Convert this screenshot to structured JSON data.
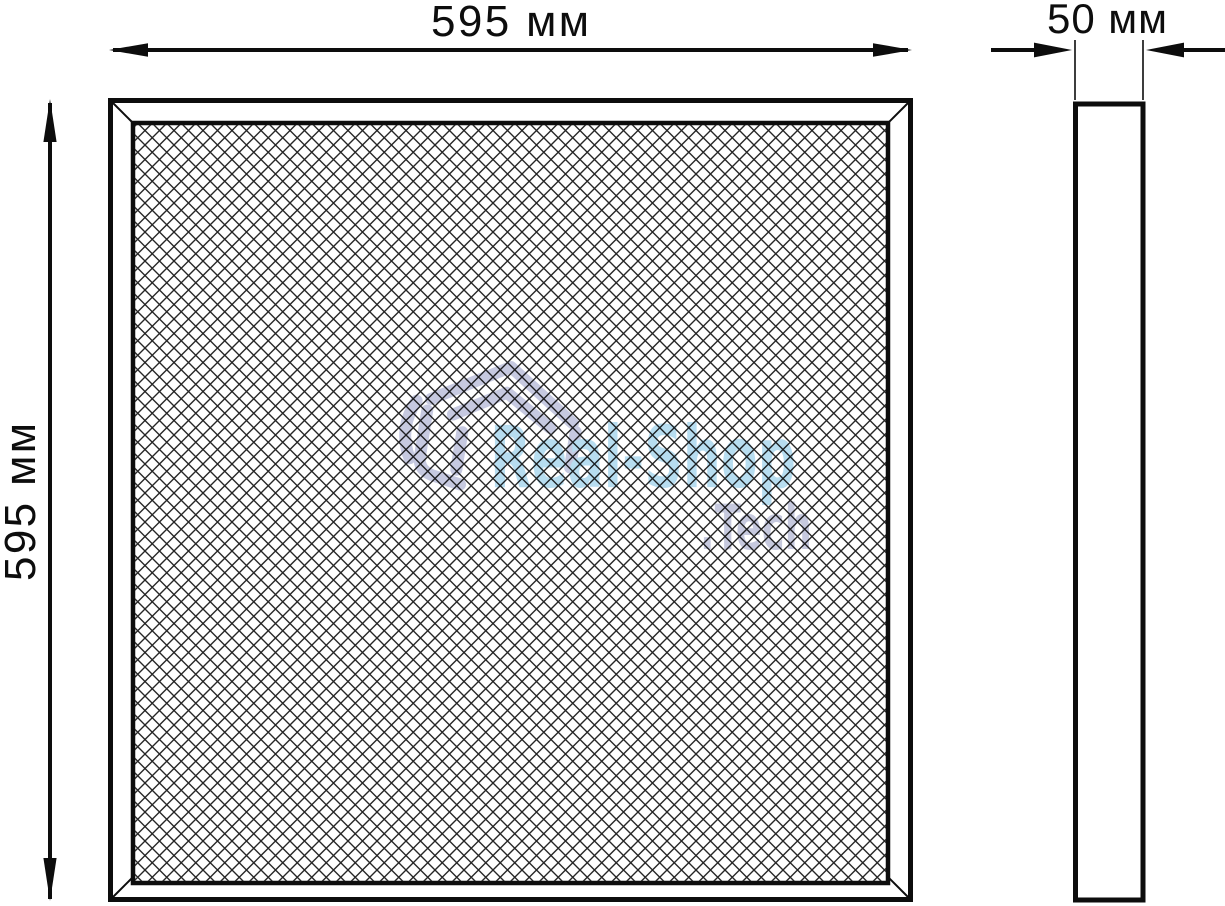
{
  "front_view": {
    "width_label": "595 мм",
    "height_label": "595 мм"
  },
  "side_view": {
    "depth_label": "50 мм"
  },
  "watermark": {
    "brand": "Real-Shop",
    "suffix": ".Tech",
    "logo_icon": "smart-home-icon",
    "brand_color": "#b7ddf0",
    "suffix_color": "#c6c9de",
    "logo_color": "#c6c9e0"
  },
  "style": {
    "background": "#ffffff",
    "line_color": "#0d0d0d",
    "mesh_line_color": "#262626"
  }
}
